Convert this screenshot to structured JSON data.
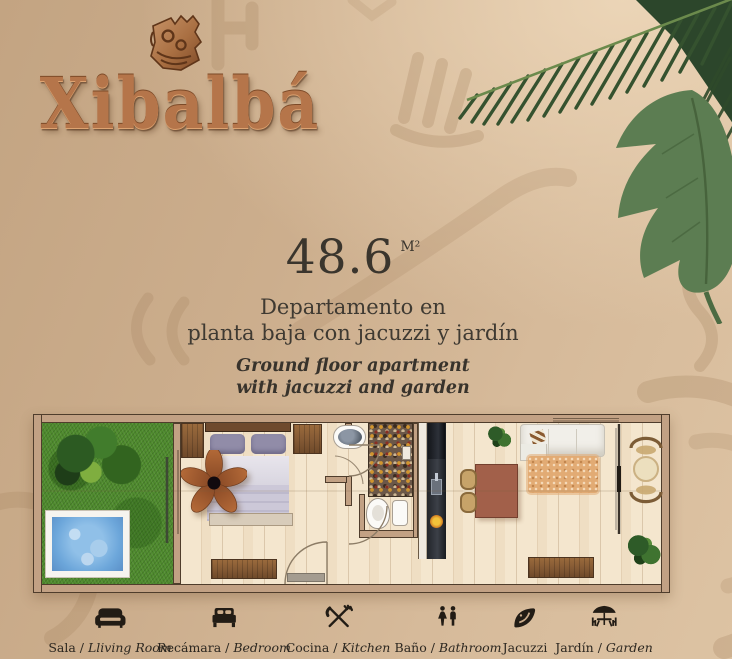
{
  "brand": {
    "name": "Xibalbá",
    "logo_icon": "mayan-bird-glyph"
  },
  "listing": {
    "area": "48.6",
    "area_unit": "M²",
    "title_es": [
      "Departamento en",
      "planta baja con jacuzzi y jardín"
    ],
    "title_en": [
      "Ground floor apartment",
      "with jacuzzi and garden"
    ]
  },
  "legend": {
    "items": [
      {
        "icon": "sofa-icon",
        "es": "Sala",
        "sep": " / ",
        "en": "Lliving Room"
      },
      {
        "icon": "bed-icon",
        "es": "Recámara",
        "sep": " / ",
        "en": "Bedroom"
      },
      {
        "icon": "cutlery-icon",
        "es": "Cocina",
        "sep": " / ",
        "en": "Kitchen"
      },
      {
        "icon": "restroom-icon",
        "es": "Baño",
        "sep": " / ",
        "en": "Bathroom"
      },
      {
        "icon": "jacuzzi-icon",
        "es": "Jacuzzi",
        "sep": "",
        "en": ""
      },
      {
        "icon": "umbrella-table-icon",
        "es": "Jardín",
        "sep": " / ",
        "en": "Garden"
      }
    ]
  },
  "floorplan": {
    "rooms": [
      "garden",
      "bedroom",
      "bathroom",
      "kitchen",
      "dining-living-room",
      "terrace"
    ],
    "features": [
      "grass",
      "garden-plants",
      "jacuzzi",
      "wardrobe",
      "double-bed",
      "ceiling-fan",
      "nightstand",
      "dresser",
      "entry-mat",
      "stone-vanity-sink",
      "mosaic-shower",
      "toilet",
      "kitchen-counter",
      "fridge",
      "sink-faucet",
      "cooking-pan",
      "dining-table",
      "dining-chairs",
      "indoor-plant",
      "sofa",
      "rug",
      "tv-console",
      "sliding-glass-door",
      "terrace-table",
      "terrace-chairs",
      "terrace-plant",
      "door-swings"
    ]
  },
  "colors": {
    "background": "#cfb192",
    "text": "#3a352d",
    "logo_copper": "#b5754a",
    "grass": "#4e8a2d",
    "jacuzzi_water": "#74aede",
    "floor": "#f4e6ce",
    "wall": "#c2a184",
    "palm_leaf": "#33502c",
    "monstera_leaf": "#5c7d52",
    "legend_icon": "#221c15"
  }
}
